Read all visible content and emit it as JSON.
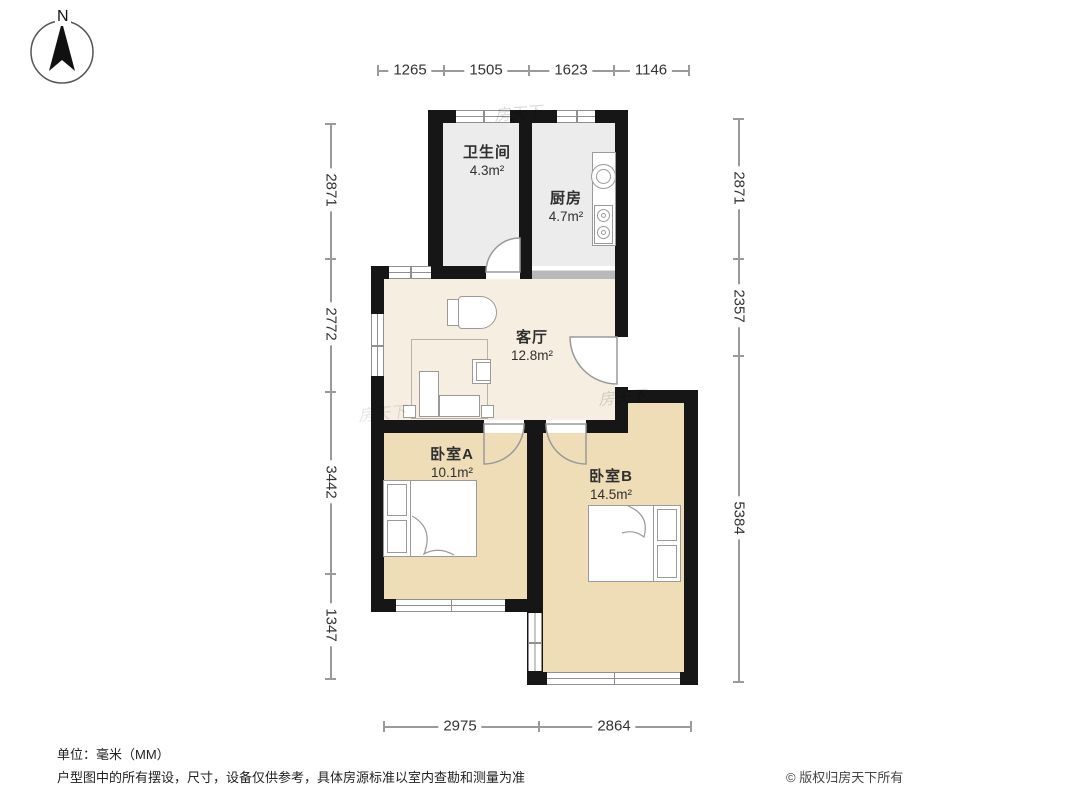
{
  "compass": {
    "label": "N"
  },
  "dimensions": {
    "top": [
      "1265",
      "1505",
      "1623",
      "1146"
    ],
    "left": [
      "2871",
      "2772",
      "3442",
      "1347"
    ],
    "right": [
      "2871",
      "2357",
      "5384"
    ],
    "bottom": [
      "2975",
      "2864"
    ]
  },
  "rooms": [
    {
      "id": "bathroom",
      "name": "卫生间",
      "area": "4.3m²"
    },
    {
      "id": "kitchen",
      "name": "厨房",
      "area": "4.7m²"
    },
    {
      "id": "living",
      "name": "客厅",
      "area": "12.8m²"
    },
    {
      "id": "bedroomA",
      "name": "卧室A",
      "area": "10.1m²"
    },
    {
      "id": "bedroomB",
      "name": "卧室B",
      "area": "14.5m²"
    }
  ],
  "footer": {
    "unit_note": "单位：毫米（MM）",
    "disclaimer": "户型图中的所有摆设，尺寸，设备仅供参考，具体房源标准以室内查勘和测量为准",
    "copyright": "© 版权归房天下所有"
  },
  "watermark": {
    "text": "房天下"
  },
  "colors": {
    "wall": "#161616",
    "wet_floor": "#ececec",
    "living_floor": "#f6efe1",
    "bedroom_floor": "#efddb8",
    "dimension_line": "#9a9a9a",
    "dimension_text": "#333333",
    "fixture_line": "#9a9a9a"
  }
}
